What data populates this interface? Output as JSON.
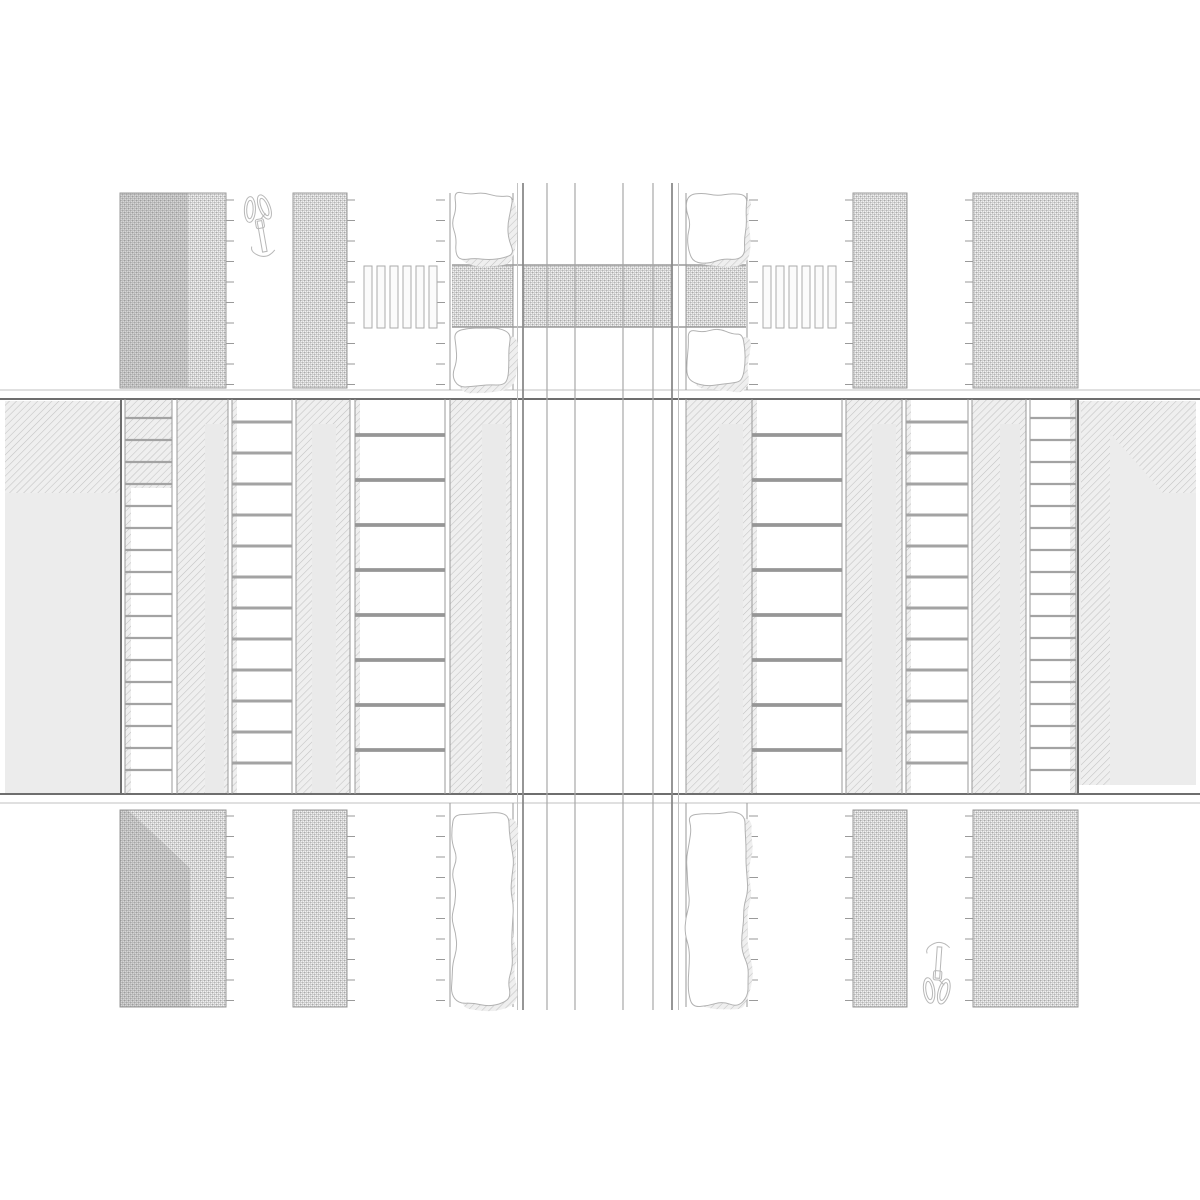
{
  "drawing": {
    "kind": "architectural-street-intersection-plan",
    "page": {
      "width": 1200,
      "height": 1200,
      "background": "#ffffff"
    },
    "palette": {
      "line_dark": "#6e6e6e",
      "line_mid": "#9a9a9a",
      "line_light": "#c2c2c2",
      "lane_edge": "#8a8a8a",
      "lane_inner": "#a8a8a8",
      "building_fill": "#ececec",
      "band_fill": "#eaeaea",
      "shadow_overlay": "rgba(110,110,110,0.20)",
      "rung_color": "#a3a3a3",
      "rung_dark": "#969696",
      "tree_stroke": "#b2b2b2",
      "bike_stroke": "#b8b8b8",
      "zebra_fill": "#fbfbfb",
      "zebra_stroke": "#ababab",
      "paving_pattern": "crosshatch",
      "walk_pattern": "diagonal-hatch"
    },
    "rects": [
      {
        "name": "crosswalk-table-left",
        "x": 452,
        "y": 265,
        "w": 61,
        "h": 62,
        "f": "xh"
      },
      {
        "name": "crosswalk-table-center",
        "x": 523,
        "y": 265,
        "w": 149,
        "h": 62,
        "f": "xh"
      },
      {
        "name": "crosswalk-table-right",
        "x": 686,
        "y": 265,
        "w": 60,
        "h": 62,
        "f": "xh"
      },
      {
        "name": "paved-block-top-left",
        "x": 120,
        "y": 193,
        "w": 106,
        "h": 195,
        "f": "xh",
        "s": "line_mid"
      },
      {
        "name": "paved-block-top-left-shade",
        "x": 121,
        "y": 193,
        "w": 67,
        "h": 194,
        "f": "shadow"
      },
      {
        "name": "paved-strip-top-left",
        "x": 293,
        "y": 193,
        "w": 54,
        "h": 195,
        "f": "xh",
        "s": "line_mid"
      },
      {
        "name": "paved-strip-top-right",
        "x": 853,
        "y": 193,
        "w": 54,
        "h": 195,
        "f": "xh",
        "s": "line_mid"
      },
      {
        "name": "paved-block-top-right",
        "x": 973,
        "y": 193,
        "w": 105,
        "h": 195,
        "f": "xh",
        "s": "line_mid"
      },
      {
        "name": "paved-block-bottom-left",
        "x": 120,
        "y": 810,
        "w": 106,
        "h": 197,
        "f": "xh",
        "s": "line_mid"
      },
      {
        "name": "paved-strip-bottom-left",
        "x": 293,
        "y": 810,
        "w": 54,
        "h": 197,
        "f": "xh",
        "s": "line_mid"
      },
      {
        "name": "paved-strip-bottom-right",
        "x": 853,
        "y": 810,
        "w": 54,
        "h": 197,
        "f": "xh",
        "s": "line_mid"
      },
      {
        "name": "paved-block-bottom-right",
        "x": 973,
        "y": 810,
        "w": 105,
        "h": 197,
        "f": "xh",
        "s": "line_mid"
      },
      {
        "name": "building-left-fill",
        "x": 5,
        "y": 401,
        "w": 116,
        "h": 392,
        "f": "building"
      },
      {
        "name": "building-left-roof-hatch",
        "x": 5,
        "y": 401,
        "w": 116,
        "h": 92,
        "f": "dh"
      },
      {
        "name": "stair-band-1-left-hatch-top",
        "x": 125,
        "y": 400,
        "w": 47,
        "h": 88,
        "f": "dh"
      },
      {
        "name": "stair-band-1-left-edge-sliver",
        "x": 125,
        "y": 488,
        "w": 6,
        "h": 305,
        "f": "dh"
      },
      {
        "name": "walkway-a-left-hatch",
        "x": 177,
        "y": 400,
        "w": 51,
        "h": 393,
        "f": "dh"
      },
      {
        "name": "walkway-a-left-inner-band",
        "x": 205,
        "y": 424,
        "w": 19,
        "h": 369,
        "f": "band"
      },
      {
        "name": "stair-band-2-left-edge-sliver",
        "x": 232,
        "y": 400,
        "w": 5,
        "h": 393,
        "f": "dh"
      },
      {
        "name": "walkway-b-left-hatch",
        "x": 296,
        "y": 400,
        "w": 54,
        "h": 393,
        "f": "dh"
      },
      {
        "name": "walkway-b-left-inner-band",
        "x": 312,
        "y": 424,
        "w": 24,
        "h": 369,
        "f": "band"
      },
      {
        "name": "stair-band-3-left-edge-sliver",
        "x": 355,
        "y": 400,
        "w": 5,
        "h": 393,
        "f": "dh"
      },
      {
        "name": "walkway-c-left-hatch",
        "x": 450,
        "y": 400,
        "w": 61,
        "h": 393,
        "f": "dh"
      },
      {
        "name": "walkway-c-left-inner-band",
        "x": 482,
        "y": 424,
        "w": 24,
        "h": 369,
        "f": "band"
      },
      {
        "name": "walkway-c-right-hatch",
        "x": 686,
        "y": 400,
        "w": 66,
        "h": 393,
        "f": "dh"
      },
      {
        "name": "walkway-c-right-inner-band",
        "x": 719,
        "y": 424,
        "w": 24,
        "h": 369,
        "f": "band"
      },
      {
        "name": "stair-band-3-right-edge-sliver",
        "x": 752,
        "y": 400,
        "w": 5,
        "h": 393,
        "f": "dh"
      },
      {
        "name": "walkway-b-right-hatch",
        "x": 846,
        "y": 400,
        "w": 56,
        "h": 393,
        "f": "dh"
      },
      {
        "name": "walkway-b-right-inner-band",
        "x": 872,
        "y": 424,
        "w": 24,
        "h": 369,
        "f": "band"
      },
      {
        "name": "stair-band-2-right-edge-sliver",
        "x": 906,
        "y": 400,
        "w": 5,
        "h": 393,
        "f": "dh"
      },
      {
        "name": "walkway-a-right-hatch",
        "x": 972,
        "y": 400,
        "w": 54,
        "h": 393,
        "f": "dh"
      },
      {
        "name": "walkway-a-right-inner-band",
        "x": 1000,
        "y": 424,
        "w": 20,
        "h": 369,
        "f": "band"
      },
      {
        "name": "stair-band-1-right-edge-sliver",
        "x": 1070,
        "y": 400,
        "w": 6,
        "h": 393,
        "f": "dh"
      },
      {
        "name": "building-right-fill",
        "x": 1078,
        "y": 401,
        "w": 118,
        "h": 384,
        "f": "building"
      },
      {
        "name": "building-right-roof-hatch-top",
        "x": 1081,
        "y": 401,
        "w": 115,
        "h": 32,
        "f": "dh"
      },
      {
        "name": "building-right-roof-hatch-column",
        "x": 1081,
        "y": 401,
        "w": 29,
        "h": 384,
        "f": "dh"
      }
    ],
    "polygons": [
      {
        "name": "paved-block-bottom-left-shade",
        "pts": [
          [
            120,
            810
          ],
          [
            128,
            810
          ],
          [
            190,
            868
          ],
          [
            190,
            1007
          ],
          [
            120,
            1007
          ]
        ],
        "f": "shadow"
      },
      {
        "name": "building-right-roof-hatch-diagonal",
        "pts": [
          [
            1110,
            433
          ],
          [
            1196,
            433
          ],
          [
            1196,
            493
          ],
          [
            1163,
            493
          ]
        ],
        "f": "dh"
      }
    ],
    "hlines": [
      {
        "name": "crosswalk-table-top-line",
        "y": 265,
        "x1": 452,
        "x2": 746,
        "w": 1.5,
        "c": "line_mid"
      },
      {
        "name": "crosswalk-table-bottom-line",
        "y": 327,
        "x1": 452,
        "x2": 746,
        "w": 1.5,
        "c": "line_mid"
      },
      {
        "name": "plaza-top-outer-line",
        "y": 390,
        "x1": 0,
        "x2": 1200,
        "w": 1,
        "c": "line_light"
      },
      {
        "name": "plaza-top-edge-line",
        "y": 399,
        "x1": 0,
        "x2": 1200,
        "w": 2,
        "c": "line_dark"
      },
      {
        "name": "plaza-bottom-edge-line",
        "y": 794,
        "x1": 0,
        "x2": 1200,
        "w": 2,
        "c": "line_dark"
      },
      {
        "name": "plaza-bottom-outer-line",
        "y": 803,
        "x1": 0,
        "x2": 1200,
        "w": 1,
        "c": "line_light"
      }
    ],
    "vlines": [
      {
        "name": "roadway-left-outer-line",
        "x": 517.5,
        "y1": 183,
        "y2": 1010,
        "w": 1,
        "c": "line_light"
      },
      {
        "name": "roadway-left-edge-line",
        "x": 523,
        "y1": 183,
        "y2": 1010,
        "w": 1.8,
        "c": "lane_edge"
      },
      {
        "name": "roadway-lane-line-1",
        "x": 547,
        "y1": 183,
        "y2": 1010,
        "w": 1.2,
        "c": "lane_inner"
      },
      {
        "name": "roadway-lane-line-2",
        "x": 575,
        "y1": 183,
        "y2": 1010,
        "w": 1.2,
        "c": "lane_inner"
      },
      {
        "name": "roadway-lane-line-3",
        "x": 623,
        "y1": 183,
        "y2": 1010,
        "w": 1.2,
        "c": "lane_inner"
      },
      {
        "name": "roadway-lane-line-4",
        "x": 653,
        "y1": 183,
        "y2": 1010,
        "w": 1.2,
        "c": "lane_inner"
      },
      {
        "name": "roadway-right-edge-line",
        "x": 672,
        "y1": 183,
        "y2": 1010,
        "w": 1.8,
        "c": "lane_edge"
      },
      {
        "name": "roadway-right-outer-line",
        "x": 678.5,
        "y1": 183,
        "y2": 1010,
        "w": 1,
        "c": "line_light"
      },
      {
        "name": "tree-strip-top-left-west-line",
        "x": 450,
        "y1": 193,
        "y2": 390,
        "w": 1,
        "c": "line_mid"
      },
      {
        "name": "tree-strip-top-left-east-line",
        "x": 513,
        "y1": 193,
        "y2": 390,
        "w": 1,
        "c": "line_mid"
      },
      {
        "name": "tree-strip-top-right-west-line",
        "x": 686,
        "y1": 193,
        "y2": 390,
        "w": 1,
        "c": "line_mid"
      },
      {
        "name": "tree-strip-top-right-east-line",
        "x": 747,
        "y1": 193,
        "y2": 390,
        "w": 1,
        "c": "line_mid"
      },
      {
        "name": "tree-strip-bottom-left-west-line",
        "x": 450,
        "y1": 803,
        "y2": 1007,
        "w": 1,
        "c": "line_mid"
      },
      {
        "name": "tree-strip-bottom-left-east-line",
        "x": 513,
        "y1": 803,
        "y2": 1007,
        "w": 1,
        "c": "line_mid"
      },
      {
        "name": "tree-strip-bottom-right-west-line",
        "x": 686,
        "y1": 803,
        "y2": 1007,
        "w": 1,
        "c": "line_mid"
      },
      {
        "name": "tree-strip-bottom-right-east-line",
        "x": 747,
        "y1": 803,
        "y2": 1007,
        "w": 1,
        "c": "line_mid"
      },
      {
        "name": "building-left-face-line",
        "x": 121,
        "y1": 399,
        "y2": 794,
        "w": 2,
        "c": "line_dark"
      },
      {
        "name": "building-right-face-line",
        "x": 1078,
        "y1": 399,
        "y2": 794,
        "w": 2,
        "c": "line_dark"
      },
      {
        "name": "band-line-125",
        "x": 125,
        "y1": 399,
        "y2": 794,
        "w": 1,
        "c": "line_mid"
      },
      {
        "name": "band-line-172",
        "x": 172,
        "y1": 399,
        "y2": 794,
        "w": 1,
        "c": "line_mid"
      },
      {
        "name": "band-line-177",
        "x": 177,
        "y1": 399,
        "y2": 794,
        "w": 1,
        "c": "line_mid"
      },
      {
        "name": "band-line-228",
        "x": 228,
        "y1": 399,
        "y2": 794,
        "w": 1,
        "c": "line_mid"
      },
      {
        "name": "band-line-232",
        "x": 232,
        "y1": 399,
        "y2": 794,
        "w": 1,
        "c": "line_mid"
      },
      {
        "name": "band-line-292",
        "x": 292,
        "y1": 399,
        "y2": 794,
        "w": 1,
        "c": "line_mid"
      },
      {
        "name": "band-line-296",
        "x": 296,
        "y1": 399,
        "y2": 794,
        "w": 1,
        "c": "line_mid"
      },
      {
        "name": "band-line-350",
        "x": 350,
        "y1": 399,
        "y2": 794,
        "w": 1,
        "c": "line_mid"
      },
      {
        "name": "band-line-355",
        "x": 355,
        "y1": 399,
        "y2": 794,
        "w": 1,
        "c": "line_mid"
      },
      {
        "name": "band-line-445",
        "x": 445,
        "y1": 399,
        "y2": 794,
        "w": 1,
        "c": "line_mid"
      },
      {
        "name": "band-line-450",
        "x": 450,
        "y1": 399,
        "y2": 794,
        "w": 1,
        "c": "line_mid"
      },
      {
        "name": "band-line-511",
        "x": 511,
        "y1": 399,
        "y2": 794,
        "w": 1,
        "c": "line_mid"
      },
      {
        "name": "band-line-686",
        "x": 686,
        "y1": 399,
        "y2": 794,
        "w": 1,
        "c": "line_mid"
      },
      {
        "name": "band-line-752",
        "x": 752,
        "y1": 399,
        "y2": 794,
        "w": 1,
        "c": "line_mid"
      },
      {
        "name": "band-line-842",
        "x": 842,
        "y1": 399,
        "y2": 794,
        "w": 1,
        "c": "line_mid"
      },
      {
        "name": "band-line-846",
        "x": 846,
        "y1": 399,
        "y2": 794,
        "w": 1,
        "c": "line_mid"
      },
      {
        "name": "band-line-902",
        "x": 902,
        "y1": 399,
        "y2": 794,
        "w": 1,
        "c": "line_mid"
      },
      {
        "name": "band-line-906",
        "x": 906,
        "y1": 399,
        "y2": 794,
        "w": 1,
        "c": "line_mid"
      },
      {
        "name": "band-line-968",
        "x": 968,
        "y1": 399,
        "y2": 794,
        "w": 1,
        "c": "line_mid"
      },
      {
        "name": "band-line-972",
        "x": 972,
        "y1": 399,
        "y2": 794,
        "w": 1,
        "c": "line_mid"
      },
      {
        "name": "band-line-1026",
        "x": 1026,
        "y1": 399,
        "y2": 794,
        "w": 1,
        "c": "line_mid"
      },
      {
        "name": "band-line-1030",
        "x": 1030,
        "y1": 399,
        "y2": 794,
        "w": 1,
        "c": "line_mid"
      },
      {
        "name": "band-line-1076",
        "x": 1076,
        "y1": 399,
        "y2": 794,
        "w": 1,
        "c": "line_mid"
      }
    ],
    "ladders": [
      {
        "name": "stair-band-1-left",
        "x1": 125,
        "x2": 172,
        "start": 418,
        "step": 22,
        "count": 17,
        "w": 2.2,
        "c": "rung_color"
      },
      {
        "name": "stair-band-2-left",
        "x1": 232,
        "x2": 292,
        "start": 422,
        "step": 31,
        "count": 12,
        "w": 3,
        "c": "rung_color"
      },
      {
        "name": "stair-band-3-left",
        "x1": 355,
        "x2": 445,
        "start": 435,
        "step": 45,
        "count": 8,
        "w": 3.8,
        "c": "rung_dark"
      },
      {
        "name": "stair-band-3-right",
        "x1": 752,
        "x2": 842,
        "start": 435,
        "step": 45,
        "count": 8,
        "w": 3.8,
        "c": "rung_dark"
      },
      {
        "name": "stair-band-2-right",
        "x1": 906,
        "x2": 968,
        "start": 422,
        "step": 31,
        "count": 12,
        "w": 3,
        "c": "rung_color"
      },
      {
        "name": "stair-band-1-right",
        "x1": 1030,
        "x2": 1076,
        "start": 418,
        "step": 22,
        "count": 17,
        "w": 2.2,
        "c": "rung_color"
      }
    ],
    "ticks": [
      {
        "name": "curb-ticks-top-block-left",
        "x": 226,
        "dir": 1,
        "y1": 200,
        "y2": 387,
        "step": 20.5,
        "len": 8
      },
      {
        "name": "curb-ticks-top-strip-left",
        "x": 347,
        "dir": 1,
        "y1": 200,
        "y2": 387,
        "step": 20.5,
        "len": 8
      },
      {
        "name": "curb-ticks-top-tree-left",
        "x": 445,
        "dir": -1,
        "y1": 200,
        "y2": 387,
        "step": 20.5,
        "len": 9
      },
      {
        "name": "curb-ticks-top-tree-right",
        "x": 749,
        "dir": 1,
        "y1": 200,
        "y2": 387,
        "step": 20.5,
        "len": 9
      },
      {
        "name": "curb-ticks-top-strip-right",
        "x": 853,
        "dir": -1,
        "y1": 200,
        "y2": 387,
        "step": 20.5,
        "len": 8
      },
      {
        "name": "curb-ticks-top-block-right",
        "x": 973,
        "dir": -1,
        "y1": 200,
        "y2": 387,
        "step": 20.5,
        "len": 8
      },
      {
        "name": "curb-ticks-bottom-block-left",
        "x": 226,
        "dir": 1,
        "y1": 816,
        "y2": 1003,
        "step": 20.5,
        "len": 8
      },
      {
        "name": "curb-ticks-bottom-strip-left",
        "x": 347,
        "dir": 1,
        "y1": 816,
        "y2": 1003,
        "step": 20.5,
        "len": 8
      },
      {
        "name": "curb-ticks-bottom-tree-left",
        "x": 445,
        "dir": -1,
        "y1": 816,
        "y2": 1003,
        "step": 20.5,
        "len": 9
      },
      {
        "name": "curb-ticks-bottom-tree-right",
        "x": 749,
        "dir": 1,
        "y1": 816,
        "y2": 1003,
        "step": 20.5,
        "len": 9
      },
      {
        "name": "curb-ticks-bottom-strip-right",
        "x": 853,
        "dir": -1,
        "y1": 816,
        "y2": 1003,
        "step": 20.5,
        "len": 8
      },
      {
        "name": "curb-ticks-bottom-block-right",
        "x": 973,
        "dir": -1,
        "y1": 816,
        "y2": 1003,
        "step": 20.5,
        "len": 8
      }
    ],
    "zebras": [
      {
        "name": "zebra-crossing-left",
        "x0": 364,
        "count": 6,
        "stripe_w": 8,
        "pitch": 13,
        "y": 266,
        "h": 62
      },
      {
        "name": "zebra-crossing-right",
        "x0": 763,
        "count": 6,
        "stripe_w": 8,
        "pitch": 13,
        "y": 266,
        "h": 62
      }
    ],
    "trees": [
      {
        "name": "tree-top-left-upper",
        "x": 454,
        "y": 194,
        "w": 57,
        "h": 67,
        "seed": 1
      },
      {
        "name": "tree-top-left-lower",
        "x": 454,
        "y": 331,
        "w": 57,
        "h": 55,
        "seed": 2
      },
      {
        "name": "tree-top-right-upper",
        "x": 688,
        "y": 194,
        "w": 57,
        "h": 67,
        "seed": 3
      },
      {
        "name": "tree-top-right-lower",
        "x": 688,
        "y": 331,
        "w": 57,
        "h": 55,
        "seed": 4
      },
      {
        "name": "tree-bottom-left",
        "x": 454,
        "y": 813,
        "w": 57,
        "h": 191,
        "seed": 5
      },
      {
        "name": "tree-bottom-right",
        "x": 688,
        "y": 813,
        "w": 57,
        "h": 191,
        "seed": 6
      }
    ],
    "bikes": [
      {
        "name": "bicycle-symbol-top-left",
        "cx": 261,
        "cy": 230,
        "flip": true,
        "rot": -10,
        "scale": 0.92
      },
      {
        "name": "bicycle-symbol-bottom-right",
        "cx": 938,
        "cy": 969,
        "flip": false,
        "rot": 4,
        "scale": 0.92
      }
    ]
  }
}
